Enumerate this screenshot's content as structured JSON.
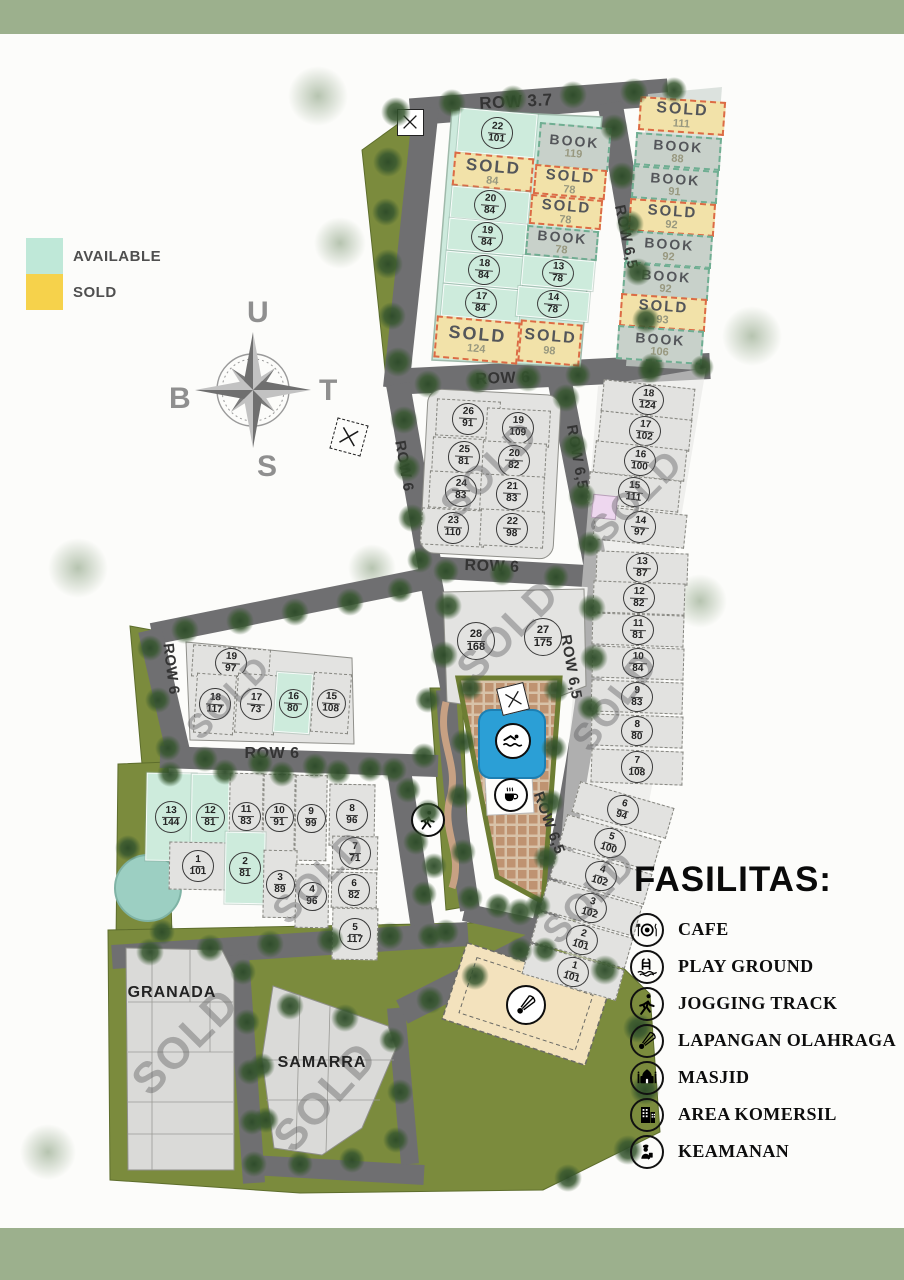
{
  "legend": {
    "available_label": "AVAILABLE",
    "sold_label": "SOLD",
    "available_color": "#bfe8d8",
    "sold_color": "#f6d24b"
  },
  "compass": {
    "north": "U",
    "east": "T",
    "south": "S",
    "west": "B"
  },
  "facilities": {
    "title": "FASILITAS:",
    "items": [
      {
        "icon": "cafe-icon",
        "label": "CAFE"
      },
      {
        "icon": "playground-icon",
        "label": "PLAY GROUND"
      },
      {
        "icon": "jogging-icon",
        "label": "JOGGING TRACK"
      },
      {
        "icon": "sport-field-icon",
        "label": "LAPANGAN OLAHRAGA"
      },
      {
        "icon": "mosque-icon",
        "label": "MASJID"
      },
      {
        "icon": "commercial-icon",
        "label": "AREA KOMERSIL"
      },
      {
        "icon": "security-icon",
        "label": "KEAMANAN"
      }
    ]
  },
  "colors": {
    "band": "#9cb08d",
    "road": "#6f6f71",
    "grass": "#7b8b3d",
    "available_plot": "#cdebdc",
    "sold_plot": "#f2e2a9",
    "book_plot": "#c8d1ca",
    "standard_plot": "#e2e2e0",
    "pool": "#2b9fd6",
    "paving": "#bf9371",
    "accent_plot": "#eed7ef"
  },
  "map": {
    "sold_word": "SOLD",
    "book_word": "BOOK",
    "road_labels": [
      {
        "t": "ROW 3.7",
        "x": 516,
        "y": 102,
        "rot": -3,
        "s": 17
      },
      {
        "t": "ROW 6,5",
        "x": 626,
        "y": 237,
        "rot": 78,
        "s": 15
      },
      {
        "t": "ROW 6",
        "x": 503,
        "y": 379,
        "rot": -2,
        "s": 16
      },
      {
        "t": "ROW 6",
        "x": 404,
        "y": 466,
        "rot": 80,
        "s": 15
      },
      {
        "t": "ROW 6,5",
        "x": 577,
        "y": 457,
        "rot": 80,
        "s": 15
      },
      {
        "t": "ROW 6",
        "x": 492,
        "y": 567,
        "rot": 2,
        "s": 16
      },
      {
        "t": "ROW 6,5",
        "x": 571,
        "y": 667,
        "rot": 80,
        "s": 15
      },
      {
        "t": "ROW 6,5",
        "x": 549,
        "y": 823,
        "rot": 70,
        "s": 15
      },
      {
        "t": "ROW 6",
        "x": 171,
        "y": 669,
        "rot": 83,
        "s": 15
      },
      {
        "t": "ROW 6",
        "x": 272,
        "y": 754,
        "rot": 0,
        "s": 16
      }
    ],
    "district_labels": [
      {
        "text": "GRANADA",
        "x": 172,
        "y": 993
      },
      {
        "text": "SAMARRA",
        "x": 322,
        "y": 1063
      }
    ],
    "watermarks": [
      {
        "text": "SOLD",
        "x": 490,
        "y": 470,
        "s": 40,
        "rot": -45
      },
      {
        "text": "SOLD",
        "x": 637,
        "y": 497,
        "s": 38,
        "rot": -45
      },
      {
        "text": "SOLD",
        "x": 616,
        "y": 702,
        "s": 38,
        "rot": -52
      },
      {
        "text": "SOLD",
        "x": 590,
        "y": 898,
        "s": 38,
        "rot": -45
      },
      {
        "text": "SOLD",
        "x": 508,
        "y": 631,
        "s": 42,
        "rot": -45
      },
      {
        "text": "SOLD",
        "x": 229,
        "y": 698,
        "s": 34,
        "rot": -45
      },
      {
        "text": "SOLD",
        "x": 320,
        "y": 878,
        "s": 38,
        "rot": -45
      },
      {
        "text": "SOLD",
        "x": 186,
        "y": 1042,
        "s": 44,
        "rot": -45
      },
      {
        "text": "SOLD",
        "x": 326,
        "y": 1097,
        "s": 44,
        "rot": -48
      }
    ],
    "plots": [
      {
        "n": "22",
        "a": "101",
        "st": "available",
        "x": 497,
        "y": 133,
        "w": 78,
        "h": 44,
        "r": 5
      },
      {
        "a": "84",
        "st": "sold",
        "x": 493,
        "y": 172,
        "w": 80,
        "h": 34,
        "r": 5,
        "ws": 17
      },
      {
        "n": "20",
        "a": "84",
        "st": "available",
        "x": 490,
        "y": 205,
        "w": 78,
        "h": 32,
        "r": 5
      },
      {
        "n": "19",
        "a": "84",
        "st": "available",
        "x": 487,
        "y": 237,
        "w": 78,
        "h": 32,
        "r": 5
      },
      {
        "n": "18",
        "a": "84",
        "st": "available",
        "x": 484,
        "y": 270,
        "w": 78,
        "h": 32,
        "r": 5
      },
      {
        "n": "17",
        "a": "84",
        "st": "available",
        "x": 481,
        "y": 303,
        "w": 78,
        "h": 32,
        "r": 5
      },
      {
        "a": "124",
        "st": "sold",
        "x": 477,
        "y": 340,
        "w": 84,
        "h": 42,
        "r": 5,
        "ws": 18
      },
      {
        "a": "98",
        "st": "sold",
        "x": 550,
        "y": 343,
        "w": 62,
        "h": 42,
        "r": 5,
        "ws": 16
      },
      {
        "a": "119",
        "st": "book",
        "x": 574,
        "y": 147,
        "w": 72,
        "h": 44,
        "r": 5
      },
      {
        "a": "78",
        "st": "sold",
        "x": 570,
        "y": 182,
        "w": 72,
        "h": 30,
        "r": 5,
        "ws": 15
      },
      {
        "a": "78",
        "st": "sold",
        "x": 566,
        "y": 212,
        "w": 72,
        "h": 30,
        "r": 5,
        "ws": 15
      },
      {
        "n": "12",
        "a": "78",
        "st": "book",
        "x": 562,
        "y": 243,
        "w": 72,
        "h": 30,
        "r": 5
      },
      {
        "n": "13",
        "a": "78",
        "st": "available",
        "x": 558,
        "y": 273,
        "w": 72,
        "h": 30,
        "r": 5
      },
      {
        "n": "14",
        "a": "78",
        "st": "available",
        "x": 553,
        "y": 304,
        "w": 72,
        "h": 30,
        "r": 5
      },
      {
        "a": "111",
        "st": "sold",
        "x": 682,
        "y": 116,
        "w": 86,
        "h": 34,
        "r": 4,
        "ws": 16
      },
      {
        "a": "88",
        "st": "book",
        "x": 678,
        "y": 151,
        "w": 86,
        "h": 33,
        "r": 4
      },
      {
        "a": "91",
        "st": "book",
        "x": 675,
        "y": 184,
        "w": 86,
        "h": 33,
        "r": 4
      },
      {
        "a": "92",
        "st": "sold",
        "x": 672,
        "y": 217,
        "w": 86,
        "h": 33,
        "r": 4,
        "ws": 15
      },
      {
        "a": "92",
        "st": "book",
        "x": 669,
        "y": 249,
        "w": 86,
        "h": 33,
        "r": 4
      },
      {
        "a": "92",
        "st": "book",
        "x": 666,
        "y": 281,
        "w": 86,
        "h": 33,
        "r": 4
      },
      {
        "a": "93",
        "st": "sold",
        "x": 663,
        "y": 312,
        "w": 86,
        "h": 33,
        "r": 4,
        "ws": 15
      },
      {
        "a": "106",
        "st": "book",
        "x": 660,
        "y": 345,
        "w": 86,
        "h": 34,
        "r": 4
      },
      {
        "n": "26",
        "a": "91",
        "st": "standard",
        "x": 468,
        "y": 418,
        "w": 64,
        "h": 37,
        "r": 3
      },
      {
        "n": "25",
        "a": "81",
        "st": "standard",
        "x": 464,
        "y": 456,
        "w": 64,
        "h": 37,
        "r": 3
      },
      {
        "n": "24",
        "a": "83",
        "st": "standard",
        "x": 461,
        "y": 490,
        "w": 64,
        "h": 37,
        "r": 3
      },
      {
        "n": "23",
        "a": "110",
        "st": "standard",
        "x": 453,
        "y": 527,
        "w": 64,
        "h": 37,
        "r": 3
      },
      {
        "n": "19",
        "a": "109",
        "st": "standard",
        "x": 518,
        "y": 427,
        "w": 64,
        "h": 37,
        "r": 3
      },
      {
        "n": "20",
        "a": "82",
        "st": "standard",
        "x": 514,
        "y": 460,
        "w": 64,
        "h": 37,
        "r": 3
      },
      {
        "n": "21",
        "a": "83",
        "st": "standard",
        "x": 512,
        "y": 493,
        "w": 64,
        "h": 37,
        "r": 3
      },
      {
        "n": "22",
        "a": "98",
        "st": "standard",
        "x": 512,
        "y": 528,
        "w": 64,
        "h": 37,
        "r": 3
      },
      {
        "n": "18",
        "a": "124",
        "st": "standard",
        "x": 648,
        "y": 400,
        "w": 92,
        "h": 32,
        "r": 6
      },
      {
        "n": "17",
        "a": "102",
        "st": "standard",
        "x": 645,
        "y": 431,
        "w": 92,
        "h": 32,
        "r": 6
      },
      {
        "n": "16",
        "a": "100",
        "st": "standard",
        "x": 640,
        "y": 461,
        "w": 92,
        "h": 32,
        "r": 6
      },
      {
        "n": "15",
        "a": "111",
        "st": "standard",
        "x": 634,
        "y": 492,
        "w": 92,
        "h": 32,
        "r": 6
      },
      {
        "n": "14",
        "a": "97",
        "st": "standard",
        "x": 640,
        "y": 527,
        "w": 92,
        "h": 34,
        "r": 6
      },
      {
        "n": "13",
        "a": "87",
        "st": "standard",
        "x": 642,
        "y": 568,
        "w": 92,
        "h": 32,
        "r": 2
      },
      {
        "n": "12",
        "a": "82",
        "st": "standard",
        "x": 639,
        "y": 598,
        "w": 92,
        "h": 32,
        "r": 2
      },
      {
        "n": "11",
        "a": "81",
        "st": "standard",
        "x": 638,
        "y": 630,
        "w": 92,
        "h": 32,
        "r": 2
      },
      {
        "n": "10",
        "a": "84",
        "st": "standard",
        "x": 638,
        "y": 663,
        "w": 92,
        "h": 32,
        "r": 2
      },
      {
        "n": "9",
        "a": "83",
        "st": "standard",
        "x": 637,
        "y": 697,
        "w": 92,
        "h": 32,
        "r": 2
      },
      {
        "n": "8",
        "a": "80",
        "st": "standard",
        "x": 637,
        "y": 731,
        "w": 92,
        "h": 32,
        "r": 2
      },
      {
        "n": "7",
        "a": "108",
        "st": "standard",
        "x": 637,
        "y": 767,
        "w": 92,
        "h": 34,
        "r": 2
      },
      {
        "n": "6",
        "a": "94",
        "st": "standard",
        "x": 623,
        "y": 810,
        "w": 98,
        "h": 32,
        "r": 16
      },
      {
        "n": "5",
        "a": "100",
        "st": "standard",
        "x": 610,
        "y": 843,
        "w": 98,
        "h": 32,
        "r": 16
      },
      {
        "n": "4",
        "a": "102",
        "st": "standard",
        "x": 601,
        "y": 876,
        "w": 98,
        "h": 32,
        "r": 16
      },
      {
        "n": "3",
        "a": "102",
        "st": "standard",
        "x": 591,
        "y": 908,
        "w": 98,
        "h": 32,
        "r": 16
      },
      {
        "n": "2",
        "a": "101",
        "st": "standard",
        "x": 582,
        "y": 940,
        "w": 98,
        "h": 32,
        "r": 16
      },
      {
        "n": "1",
        "a": "101",
        "st": "standard",
        "x": 573,
        "y": 972,
        "w": 98,
        "h": 32,
        "r": 16
      },
      {
        "st": "accent",
        "x": 604,
        "y": 507,
        "w": 25,
        "h": 24,
        "r": 6
      },
      {
        "n": "28",
        "a": "168",
        "st": "bare",
        "x": 476,
        "y": 641,
        "w": 60,
        "h": 60,
        "bd": 36
      },
      {
        "n": "27",
        "a": "175",
        "st": "bare",
        "x": 543,
        "y": 637,
        "w": 60,
        "h": 60,
        "bd": 36
      },
      {
        "n": "19",
        "a": "97",
        "st": "standard",
        "x": 231,
        "y": 663,
        "w": 78,
        "h": 32,
        "r": 4
      },
      {
        "n": "18",
        "a": "117",
        "st": "standard",
        "x": 215,
        "y": 704,
        "w": 40,
        "h": 60,
        "r": 4
      },
      {
        "n": "17",
        "a": "73",
        "st": "standard",
        "x": 256,
        "y": 704,
        "w": 40,
        "h": 60,
        "r": 4
      },
      {
        "n": "16",
        "a": "80",
        "st": "available",
        "x": 293,
        "y": 703,
        "w": 36,
        "h": 60,
        "r": 4
      },
      {
        "n": "15",
        "a": "108",
        "st": "standard",
        "x": 331,
        "y": 703,
        "w": 38,
        "h": 60,
        "r": 4
      },
      {
        "n": "13",
        "a": "144",
        "st": "available",
        "x": 171,
        "y": 817,
        "w": 50,
        "h": 88,
        "r": 1
      },
      {
        "n": "12",
        "a": "81",
        "st": "available",
        "x": 210,
        "y": 817,
        "w": 38,
        "h": 86,
        "r": 1
      },
      {
        "n": "11",
        "a": "83",
        "st": "standard",
        "x": 246,
        "y": 816,
        "w": 34,
        "h": 86,
        "r": 1
      },
      {
        "n": "10",
        "a": "91",
        "st": "standard",
        "x": 279,
        "y": 817,
        "w": 32,
        "h": 86,
        "r": 1
      },
      {
        "n": "9",
        "a": "99",
        "st": "standard",
        "x": 311,
        "y": 818,
        "w": 32,
        "h": 86,
        "r": 1
      },
      {
        "n": "8",
        "a": "96",
        "st": "standard",
        "x": 352,
        "y": 815,
        "w": 46,
        "h": 62,
        "r": 1
      },
      {
        "n": "7",
        "a": "71",
        "st": "standard",
        "x": 355,
        "y": 853,
        "w": 46,
        "h": 34,
        "r": 1
      },
      {
        "n": "6",
        "a": "82",
        "st": "standard",
        "x": 354,
        "y": 890,
        "w": 46,
        "h": 36,
        "r": 1
      },
      {
        "n": "5",
        "a": "117",
        "st": "standard",
        "x": 355,
        "y": 934,
        "w": 46,
        "h": 52,
        "r": 1
      },
      {
        "n": "1",
        "a": "101",
        "st": "standard",
        "x": 198,
        "y": 866,
        "w": 58,
        "h": 48,
        "r": 1
      },
      {
        "n": "2",
        "a": "81",
        "st": "available",
        "x": 245,
        "y": 868,
        "w": 40,
        "h": 72,
        "r": 1
      },
      {
        "n": "3",
        "a": "89",
        "st": "standard",
        "x": 280,
        "y": 884,
        "w": 34,
        "h": 68,
        "r": 1
      },
      {
        "n": "4",
        "a": "96",
        "st": "standard",
        "x": 312,
        "y": 896,
        "w": 34,
        "h": 64,
        "r": 1
      }
    ],
    "icons": [
      {
        "name": "swimmer-icon",
        "glyph": "swimmer",
        "x": 513,
        "y": 741,
        "d": 36
      },
      {
        "name": "coffee-icon",
        "glyph": "coffee",
        "x": 511,
        "y": 795,
        "d": 34
      },
      {
        "name": "jogging-runner-icon",
        "glyph": "runner",
        "x": 428,
        "y": 820,
        "d": 34
      },
      {
        "name": "shuttlecock-icon",
        "glyph": "shuttle",
        "x": 526,
        "y": 1005,
        "d": 40
      },
      {
        "name": "gate-marker-icon",
        "glyph": "x",
        "x": 410,
        "y": 122,
        "d": 27,
        "variant": "square"
      },
      {
        "name": "site-marker-icon",
        "glyph": "x",
        "x": 349,
        "y": 437,
        "d": 32,
        "variant": "square dashed",
        "rot": 15
      },
      {
        "name": "plaza-marker-icon",
        "glyph": "x",
        "x": 513,
        "y": 699,
        "d": 28,
        "variant": "square",
        "rot": -14
      }
    ]
  }
}
